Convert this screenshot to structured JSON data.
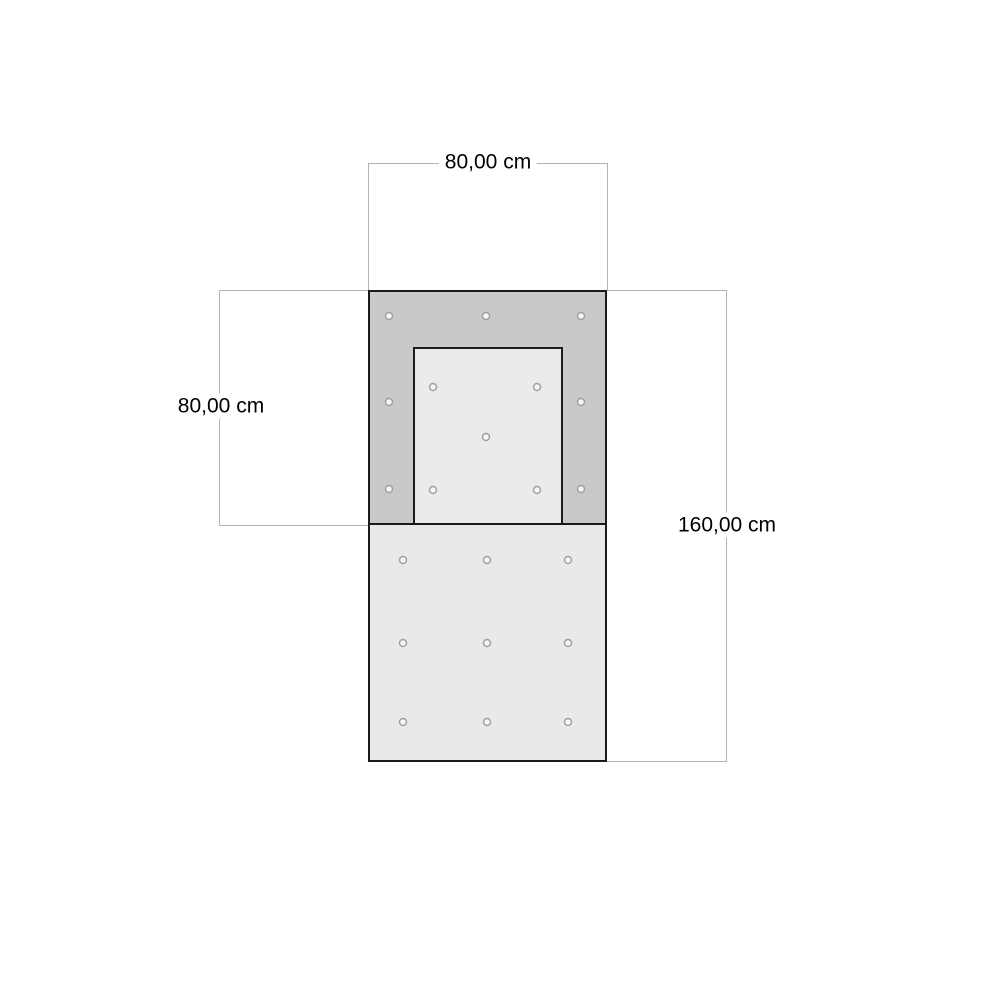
{
  "page": {
    "background": "#ffffff"
  },
  "diagram": {
    "type": "dimensioned-drawing",
    "unit": "cm",
    "dimensions": {
      "top_width": {
        "label": "80,00 cm",
        "value": 80
      },
      "left_height": {
        "label": "80,00 cm",
        "value": 80
      },
      "right_height": {
        "label": "160,00 cm",
        "value": 160
      }
    },
    "colors": {
      "outline": "#1a1a1a",
      "frame_fill": "#c9c9c9",
      "inner_fill": "#ebebeb",
      "panel_fill": "#e9e9e9",
      "dim_line": "#b4b4b4",
      "hole_stroke": "#9e9e9e",
      "hole_fill": "#f6f6f6",
      "text": "#000000"
    },
    "holes": {
      "radius": 3.5,
      "groups": {
        "frame": [
          [
            389,
            316
          ],
          [
            486,
            316
          ],
          [
            581,
            316
          ],
          [
            389,
            402
          ],
          [
            581,
            402
          ],
          [
            389,
            489
          ],
          [
            581,
            489
          ]
        ],
        "inner": [
          [
            433,
            387
          ],
          [
            537,
            387
          ],
          [
            486,
            437
          ],
          [
            433,
            490
          ],
          [
            537,
            490
          ]
        ],
        "bottom": [
          [
            403,
            560
          ],
          [
            487,
            560
          ],
          [
            568,
            560
          ],
          [
            403,
            643
          ],
          [
            487,
            643
          ],
          [
            568,
            643
          ],
          [
            403,
            722
          ],
          [
            487,
            722
          ],
          [
            568,
            722
          ]
        ]
      }
    }
  }
}
